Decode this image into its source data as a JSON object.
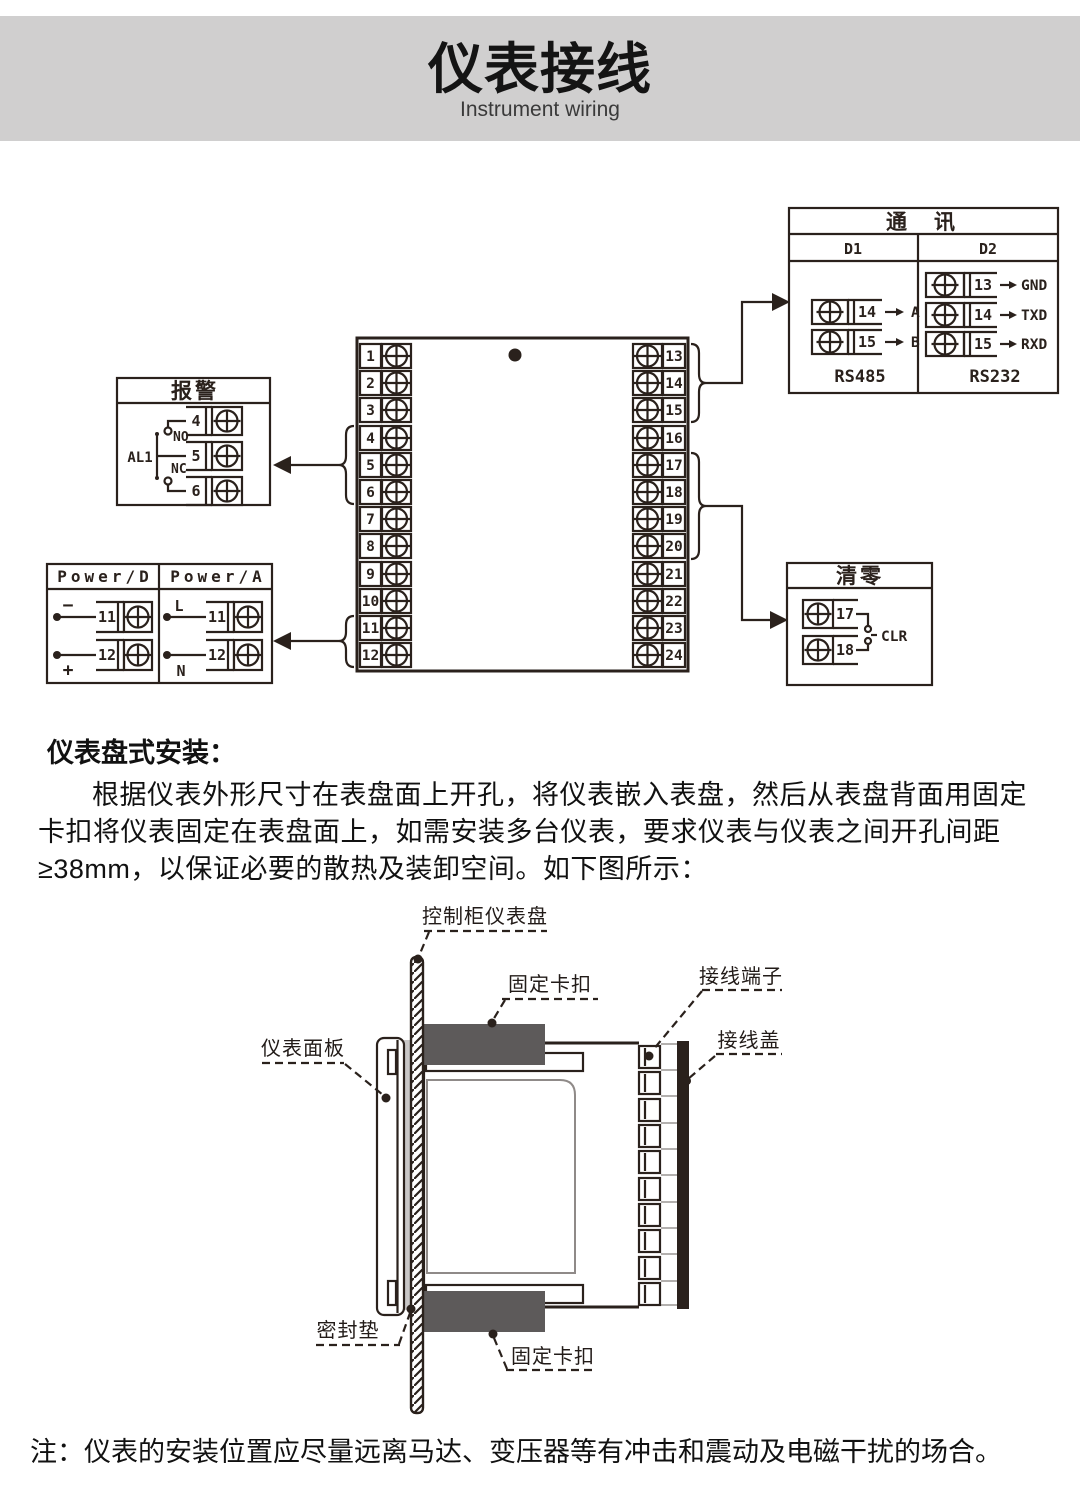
{
  "header": {
    "title": "仪表接线",
    "subtitle": "Instrument wiring"
  },
  "wiring": {
    "comm": {
      "title": "通　讯",
      "col1": "D1",
      "col2": "D2",
      "rs485": "RS485",
      "rs232": "RS232",
      "d1_rows": [
        {
          "num": "14",
          "label": "A"
        },
        {
          "num": "15",
          "label": "B"
        }
      ],
      "d2_rows": [
        {
          "num": "13",
          "label": "GND"
        },
        {
          "num": "14",
          "label": "TXD"
        },
        {
          "num": "15",
          "label": "RXD"
        }
      ]
    },
    "alarm": {
      "title": "报警",
      "relay": "AL1",
      "no": "NO",
      "nc": "NC",
      "t1": "4",
      "t2": "5",
      "t3": "6"
    },
    "power": {
      "dc_title": "Power/D",
      "ac_title": "Power/A",
      "dc_minus": "−",
      "dc_plus": "+",
      "ac_l": "L",
      "ac_n": "N",
      "t11": "11",
      "t12": "12",
      "t11a": "11",
      "t12a": "12"
    },
    "clear": {
      "title": "清零",
      "t17": "17",
      "t18": "18",
      "label": "CLR"
    },
    "block": {
      "left": [
        "1",
        "2",
        "3",
        "4",
        "5",
        "6",
        "7",
        "8",
        "9",
        "10",
        "11",
        "12"
      ],
      "right": [
        "13",
        "14",
        "15",
        "16",
        "17",
        "18",
        "19",
        "20",
        "21",
        "22",
        "23",
        "24"
      ]
    }
  },
  "install": {
    "heading": "仪表盘式安装：",
    "paragraph": "根据仪表外形尺寸在表盘面上开孔，将仪表嵌入表盘，然后从表盘背面用固定卡扣将仪表固定在表盘面上，如需安装多台仪表，要求仪表与仪表之间开孔间距≥38mm，以保证必要的散热及装卸空间。如下图所示：",
    "labels": {
      "panel": "控制柜仪表盘",
      "clip_top": "固定卡扣",
      "terminal": "接线端子",
      "cover": "接线盖",
      "front": "仪表面板",
      "gasket": "密封垫",
      "clip_bottom": "固定卡扣"
    }
  },
  "note": "注：仪表的安装位置应尽量远离马达、变压器等有冲击和震动及电磁干扰的场合。",
  "colors": {
    "band": "#d0cfcf",
    "ink": "#2a211c",
    "clip": "#5d5a5a",
    "gasket": "#c9c7c7",
    "gray_line": "#b3b0ae"
  }
}
